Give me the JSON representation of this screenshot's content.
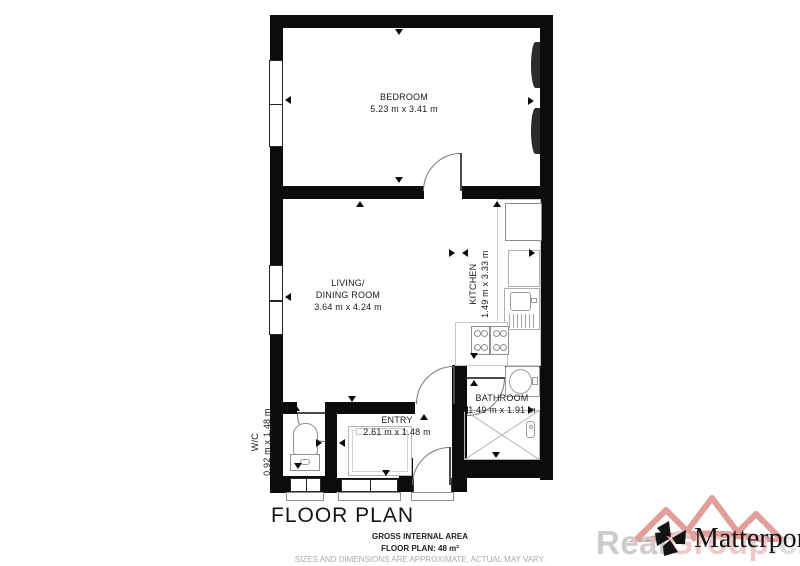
{
  "heading": "FLOOR PLAN",
  "rooms": {
    "bedroom": {
      "label": "BEDROOM",
      "size": "5.23 m x 3.41 m"
    },
    "living": {
      "label_line1": "LIVING/",
      "label_line2": "DINING ROOM",
      "size": "3.64 m x 4.24 m"
    },
    "kitchen": {
      "label": "KITCHEN",
      "size": "1.49 m x 3.33 m"
    },
    "bathroom": {
      "label": "BATHROOM",
      "size": "1.49 m x 1.91 m"
    },
    "entry": {
      "label": "ENTRY",
      "size": "2.61 m x 1.48 m"
    },
    "wc": {
      "label": "W/C",
      "size": "0.92 m x 1.48 m"
    }
  },
  "footer": {
    "gross": "GROSS INTERNAL AREA",
    "area": "FLOOR PLAN: 48 m²",
    "disclaimer": "SIZES AND DIMENSIONS ARE APPROXIMATE, ACTUAL MAY VARY."
  },
  "branding": {
    "matterport": "Matterport",
    "trademark": "™",
    "watermark_prefix": "Real",
    "watermark_mid": "Group",
    "watermark_suffix": ".cz"
  },
  "colors": {
    "wall": "#0c0c0c",
    "fixture_line": "#9a9a9a",
    "watermark_red": "#c94f49"
  }
}
